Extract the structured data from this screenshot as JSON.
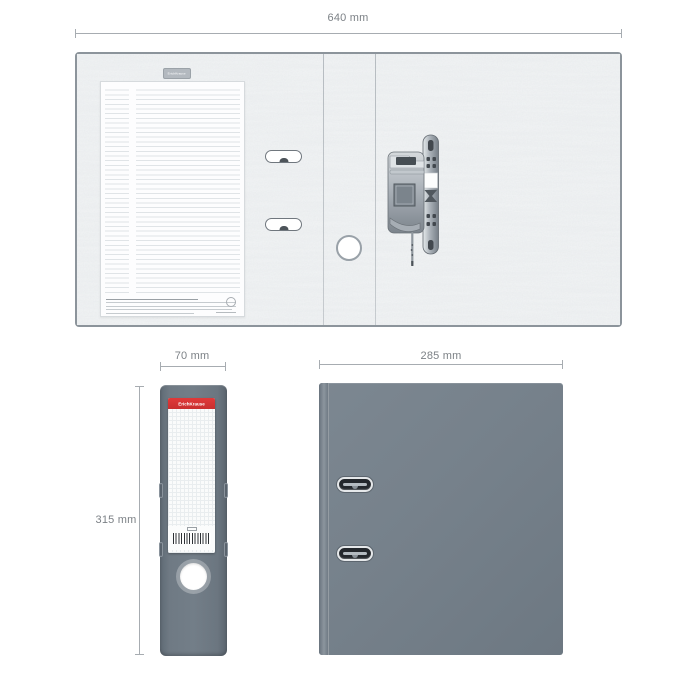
{
  "brand": {
    "name": "ErichKrause"
  },
  "annotations": {
    "open_width": "640 mm",
    "spine_width": "70 mm",
    "height": "315 mm",
    "cover_width": "285 mm"
  },
  "icons": {
    "mechanism": "lever-arch-mechanism",
    "barcode": "barcode",
    "finger_hole": "finger-hole"
  },
  "colors": {
    "cover_gray": "#75808a",
    "spine_gray": "#6f7a84",
    "accent_red": "#d63434",
    "texture_base": "#f2f4f5",
    "outline_gray": "#8c949b",
    "dimension_gray": "#7c8186"
  }
}
